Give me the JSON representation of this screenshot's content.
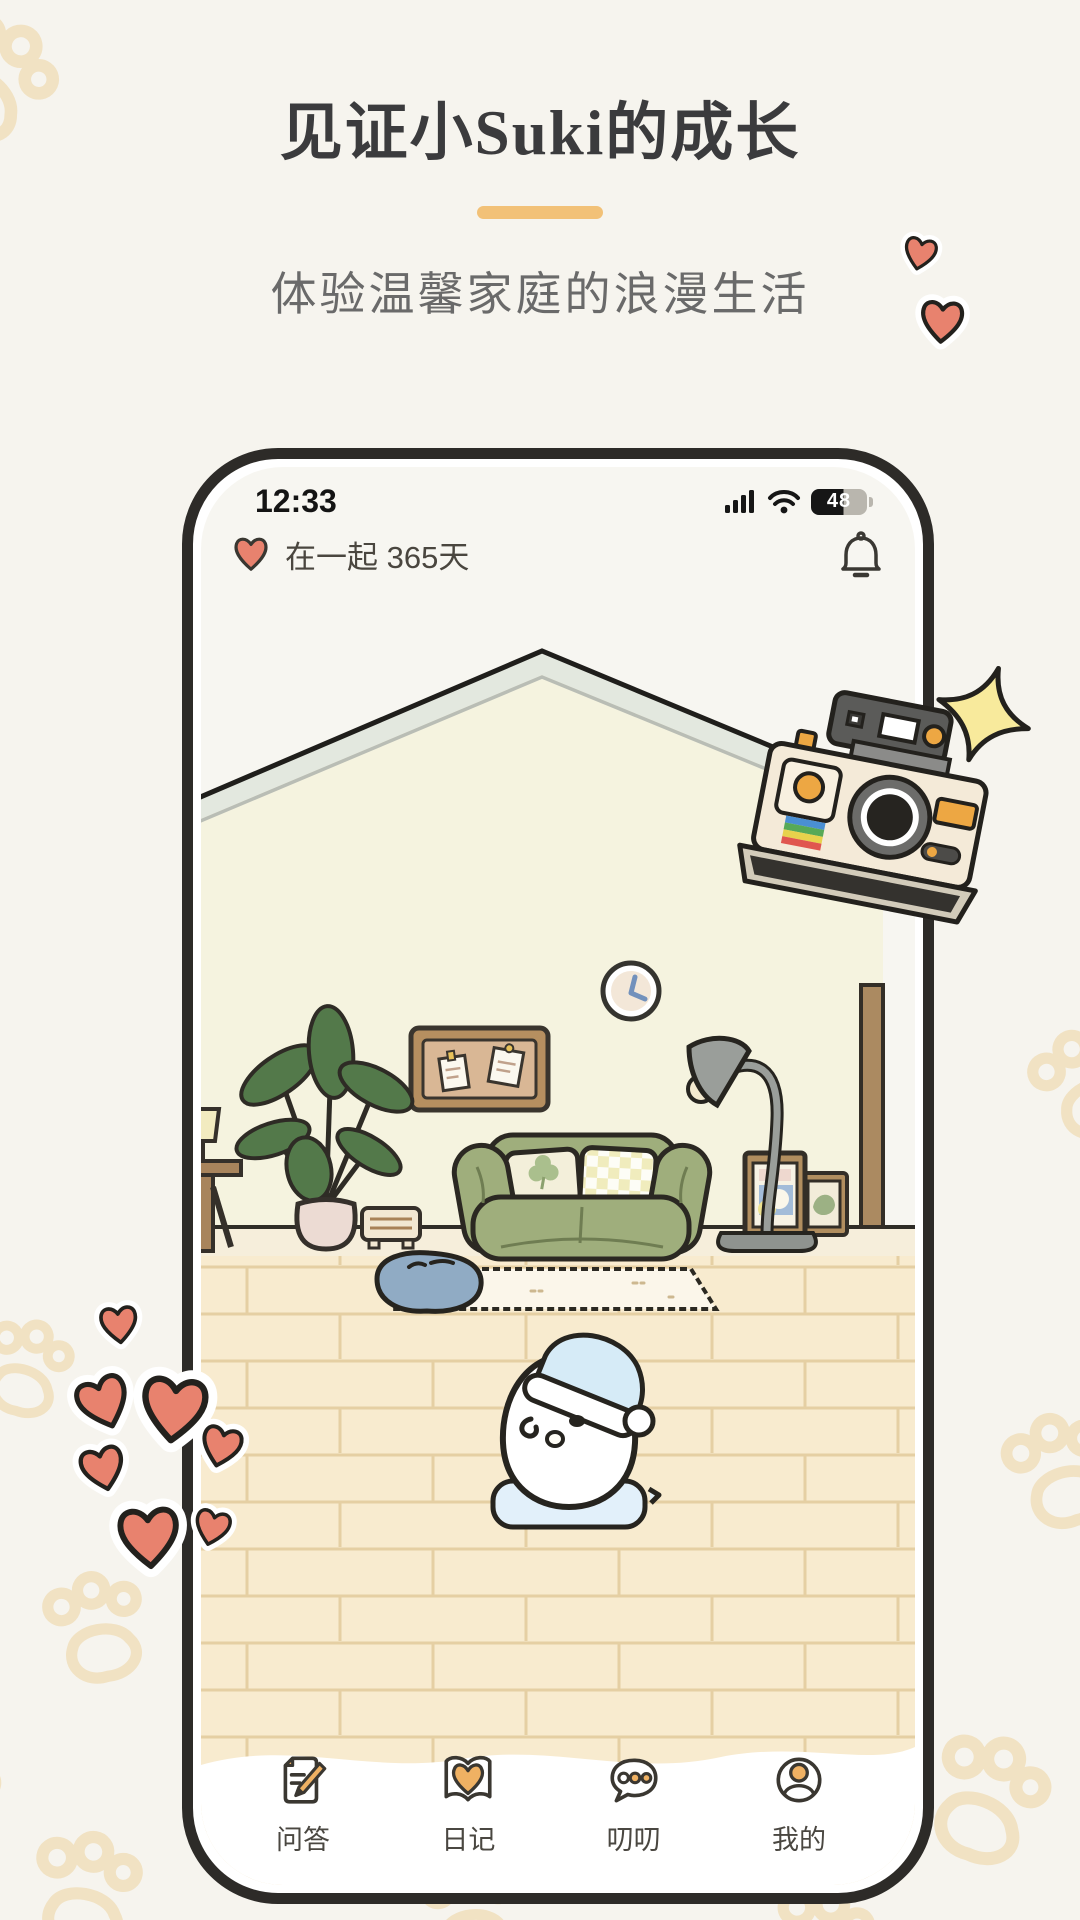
{
  "hero": {
    "title": "见证小Suki的成长",
    "subtitle": "体验温馨家庭的浪漫生活"
  },
  "phone": {
    "status": {
      "time": "12:33",
      "battery_percent": "48"
    },
    "header": {
      "relationship_text": "在一起 365天"
    },
    "tabbar": {
      "items": [
        {
          "label": "问答",
          "icon": "qa-doc-pencil-icon"
        },
        {
          "label": "日记",
          "icon": "diary-book-heart-icon"
        },
        {
          "label": "叨叨",
          "icon": "chat-bubble-dots-icon"
        },
        {
          "label": "我的",
          "icon": "profile-person-icon"
        }
      ]
    }
  },
  "illustration": {
    "scene": "cozy-living-room",
    "character": "white-egg-mascot-with-sleeping-cap",
    "props": [
      "polaroid-camera",
      "sparkle",
      "potted-plant",
      "green-sofa",
      "arc-floor-lamp",
      "wall-clock",
      "bulletin-board",
      "picture-frames",
      "pet-bed",
      "rug",
      "radio",
      "side-table",
      "door-panel"
    ]
  },
  "colors": {
    "page_bg": "#f6f4ee",
    "accent_orange": "#f2c177",
    "icon_orange": "#efb163",
    "heart_coral": "#e8826e",
    "phone_frame": "#2d2b28",
    "screen_bg": "#f7f6f1",
    "wall_yellow": "#f5f3df",
    "roof_band": "#e3e8df",
    "floor_cream": "#f8ebcf",
    "sofa_green": "#9fae7c",
    "cap_blue": "#d6ebf7",
    "pet_bed_blue": "#90abc4",
    "paw_tan": "#f1e2c3"
  }
}
